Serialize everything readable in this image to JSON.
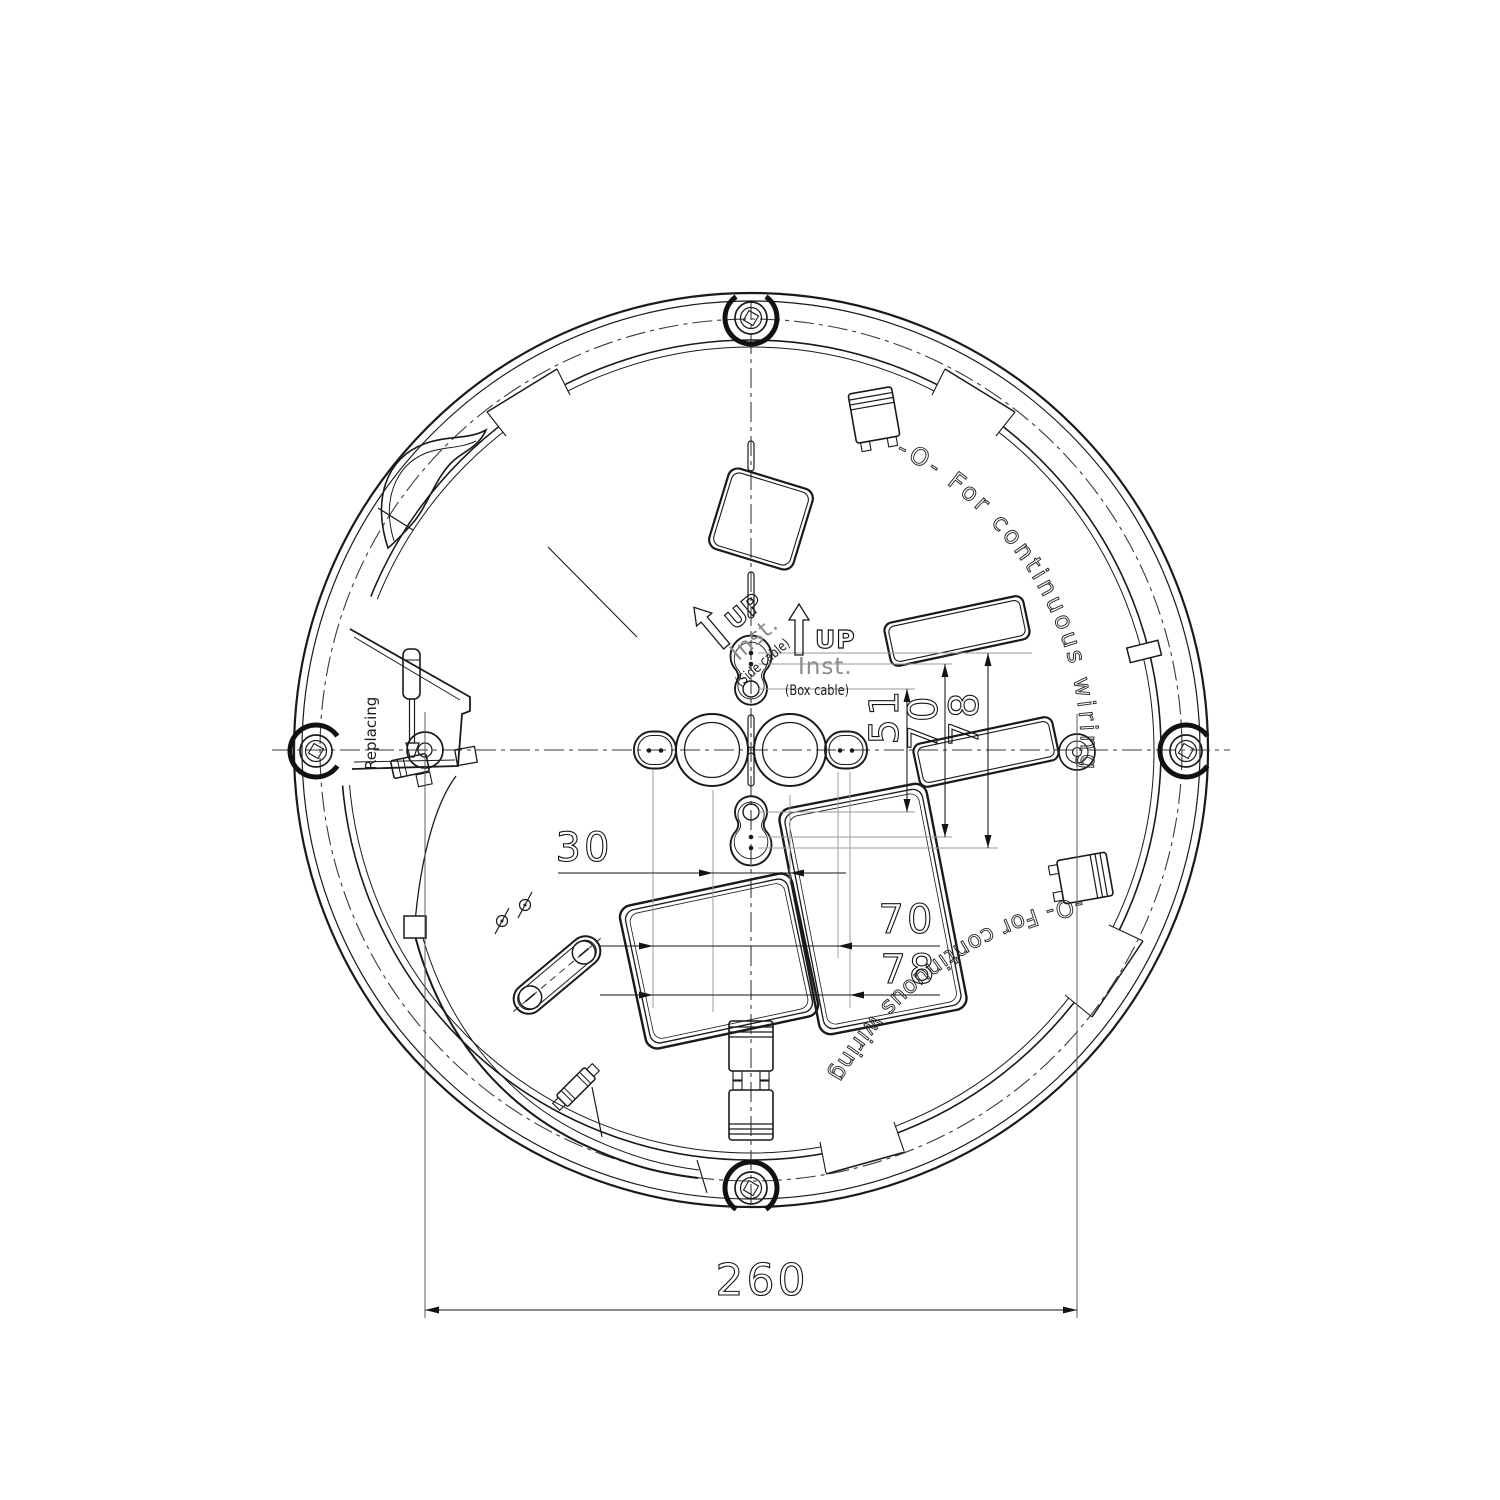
{
  "meta": {
    "type": "technical-drawing",
    "units": "mm"
  },
  "dimensions": {
    "overall_width": "260",
    "hole_pitch_30": "30",
    "keyhole_pitch_51": "51",
    "vertical_70": "70",
    "vertical_78": "78",
    "horizontal_70": "70",
    "horizontal_78": "78"
  },
  "labels": {
    "up_box": "UP",
    "inst_box": "Inst.",
    "cable_box": "(Box cable)",
    "up_side": "UP",
    "inst_side": "Inst.",
    "cable_side": "(Side cable)",
    "replacing": "Replacing",
    "continuous_wiring_top": "-O- For continuous wiring",
    "continuous_wiring_bottom": "-O- For continuous wiring"
  },
  "colors": {
    "line": "#1a1a1a",
    "extension": "#9a9a9a",
    "background": "#ffffff"
  }
}
